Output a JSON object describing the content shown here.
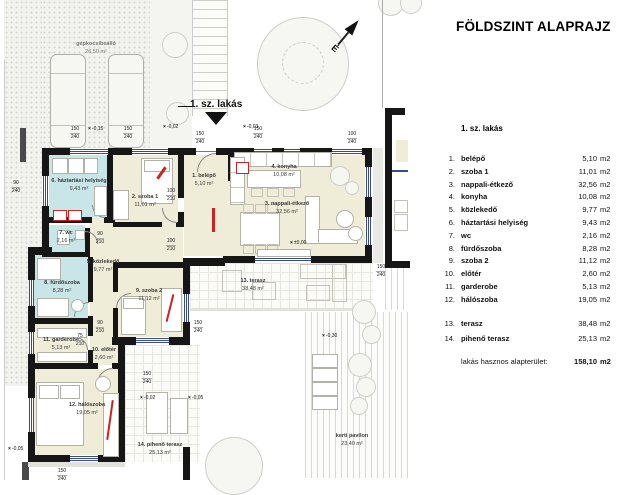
{
  "panel": {
    "title": "FÖLDSZINT ALAPRAJZ",
    "unit_header": "1. sz. lakás",
    "rooms": [
      {
        "num": "1.",
        "name": "belépő",
        "area": "5,10",
        "unit": "m2"
      },
      {
        "num": "2.",
        "name": "szoba 1",
        "area": "11,01",
        "unit": "m2"
      },
      {
        "num": "3.",
        "name": "nappali-étkező",
        "area": "32,56",
        "unit": "m2"
      },
      {
        "num": "4.",
        "name": "konyha",
        "area": "10,08",
        "unit": "m2"
      },
      {
        "num": "5.",
        "name": "közlekedő",
        "area": "9,77",
        "unit": "m2"
      },
      {
        "num": "6.",
        "name": "háztartási helyiség",
        "area": "9,43",
        "unit": "m2"
      },
      {
        "num": "7.",
        "name": "wc",
        "area": "2,16",
        "unit": "m2"
      },
      {
        "num": "8.",
        "name": "fürdőszoba",
        "area": "8,28",
        "unit": "m2"
      },
      {
        "num": "9.",
        "name": "szoba 2",
        "area": "11,12",
        "unit": "m2"
      },
      {
        "num": "10.",
        "name": "előtér",
        "area": "2,60",
        "unit": "m2"
      },
      {
        "num": "11.",
        "name": "garderobe",
        "area": "5,13",
        "unit": "m2"
      },
      {
        "num": "12.",
        "name": "hálószoba",
        "area": "19,05",
        "unit": "m2"
      },
      {
        "num": "13.",
        "name": "terasz",
        "area": "38,48",
        "unit": "m2"
      },
      {
        "num": "14.",
        "name": "pihenő terasz",
        "area": "25,13",
        "unit": "m2"
      }
    ],
    "total_label": "lakás hasznos alapterület:",
    "total_value": "158,10",
    "total_unit": "m2"
  },
  "plan": {
    "pointer_label": "1. sz. lakás",
    "north_label": "É",
    "labels": [
      {
        "l1": "1. belépő",
        "l2": "5,10 m²"
      },
      {
        "l1": "2. szoba 1",
        "l2": "11,01 m²"
      },
      {
        "l1": "3. nappali-étkező",
        "l2": "32,56 m²"
      },
      {
        "l1": "4. konyha",
        "l2": "10,08 m²"
      },
      {
        "l1": "5. közlekedő",
        "l2": "9,77 m²"
      },
      {
        "l1": "6. háztartási helyiség",
        "l2": "9,43 m²"
      },
      {
        "l1": "7. wc",
        "l2": "2,16 m²"
      },
      {
        "l1": "8. fürdőszoba",
        "l2": "8,28 m²"
      },
      {
        "l1": "9. szoba 2",
        "l2": "11,12 m²"
      },
      {
        "l1": "10. előtér",
        "l2": "2,60 m²"
      },
      {
        "l1": "11. garderobe",
        "l2": "5,13 m²"
      },
      {
        "l1": "12. hálószoba",
        "l2": "19,05 m²"
      },
      {
        "l1": "13. terasz",
        "l2": "38,48 m²"
      },
      {
        "l1": "14. pihenő terasz",
        "l2": "25,13 m²"
      },
      {
        "l1": "gépkocsibeálló",
        "l2": "26,50 m²"
      },
      {
        "l1": "kerti pavilon",
        "l2": "23,40 m²"
      }
    ],
    "dims": [
      {
        "a": "150",
        "b": "240"
      },
      {
        "a": "150",
        "b": "240"
      },
      {
        "a": "150",
        "b": "240"
      },
      {
        "a": "150",
        "b": "240"
      },
      {
        "a": "100",
        "b": "240"
      },
      {
        "a": "90",
        "b": "240"
      },
      {
        "a": "100",
        "b": "210"
      },
      {
        "a": "100",
        "b": "210"
      },
      {
        "a": "90",
        "b": "210"
      },
      {
        "a": "90",
        "b": "210"
      },
      {
        "a": "75",
        "b": "210"
      },
      {
        "a": "150",
        "b": "240"
      },
      {
        "a": "150",
        "b": "240"
      },
      {
        "a": "150",
        "b": "240"
      },
      {
        "a": "150",
        "b": "240"
      }
    ],
    "marks": [
      {
        "t": "-0,15"
      },
      {
        "t": "-0,02"
      },
      {
        "t": "-0,03"
      },
      {
        "t": "±0,00"
      },
      {
        "t": "-0,02"
      },
      {
        "t": "-0,05"
      },
      {
        "t": "-0,30"
      },
      {
        "t": "-0,05"
      }
    ]
  },
  "colors": {
    "wall": "#161616",
    "room_dry": "#efecd7",
    "room_wet": "#c8e5e7",
    "window": "#3a4a8f",
    "accent_red": "#cc2222",
    "ground": "#f2f2ee"
  }
}
